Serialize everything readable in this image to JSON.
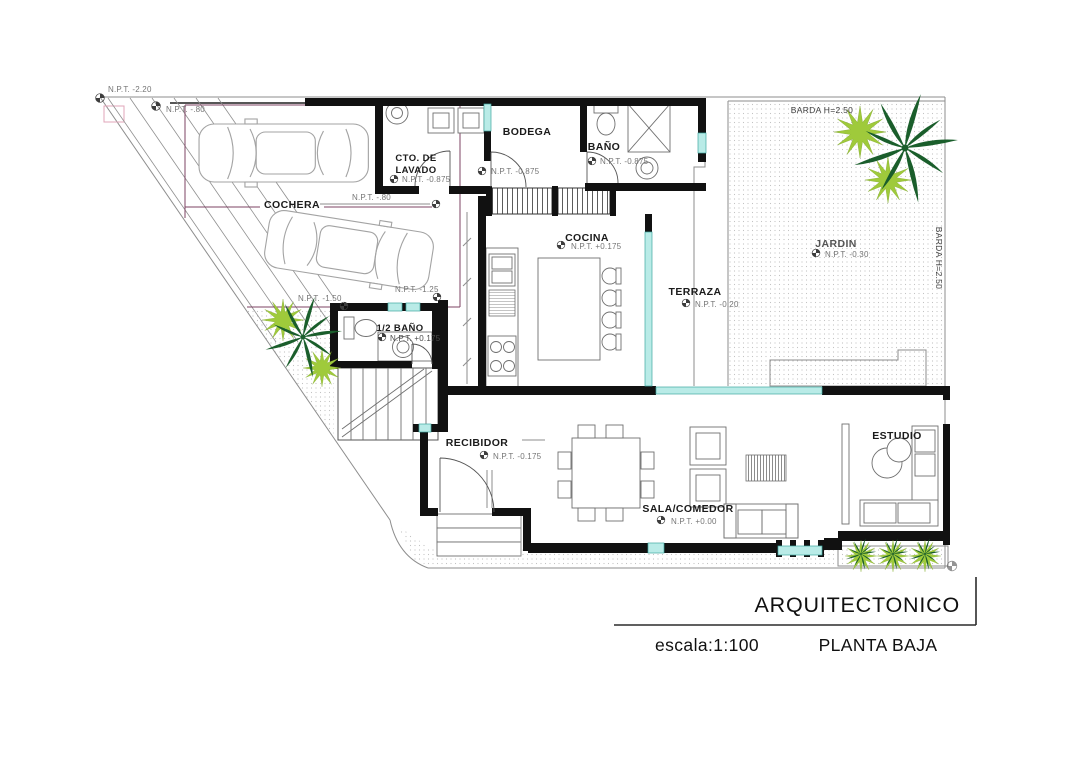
{
  "drawing": {
    "type": "architectural floor plan",
    "title_block": {
      "title": "ARQUITECTONICO",
      "scale": "escala:1:100",
      "plan": "PLANTA BAJA"
    }
  },
  "site": {
    "barda_top": "BARDA H=2.50",
    "barda_right": "BARDA H=2.50",
    "npt_terreno": "N.P.T. -2.20",
    "npt_acera": "N.P.T. -.80",
    "npt_rampa": "N.P.T. -1.50",
    "npt_patio": "N.P.T. -1.25"
  },
  "rooms": {
    "cochera": {
      "name": "COCHERA",
      "npt": "N.P.T. -.80"
    },
    "lavado": {
      "line1": "CTO. DE",
      "line2": "LAVADO",
      "npt": "N.P.T. -0.875"
    },
    "bodega": {
      "name": "BODEGA",
      "npt": "N.P.T. -0.875"
    },
    "bano": {
      "name": "BAÑO",
      "npt": "N.P.T. -0.875"
    },
    "cocina": {
      "name": "COCINA",
      "npt": "N.P.T. +0.175"
    },
    "terraza": {
      "name": "TERRAZA",
      "npt": "N.P.T. -0.20"
    },
    "jardin": {
      "name": "JARDIN",
      "npt": "N.P.T. -0.30"
    },
    "medio_bano": {
      "name": "1/2 BAÑO",
      "npt": "N.P.T. +0.175"
    },
    "recibidor": {
      "name": "RECIBIDOR",
      "npt": "N.P.T. -0.175"
    },
    "sala": {
      "name": "SALA/COMEDOR",
      "npt": "N.P.T. +0.00"
    },
    "estudio": {
      "name": "ESTUDIO"
    }
  },
  "colors": {
    "wall": "#111111",
    "window_glass": "#b9ebe7",
    "window_frame": "#3fa8a2",
    "plant_dark": "#1a5e2b",
    "plant_light": "#9fca3b",
    "cochera_line": "#7d4363",
    "site_line": "#9a9a9a",
    "stipple": "#c2c2c2"
  }
}
